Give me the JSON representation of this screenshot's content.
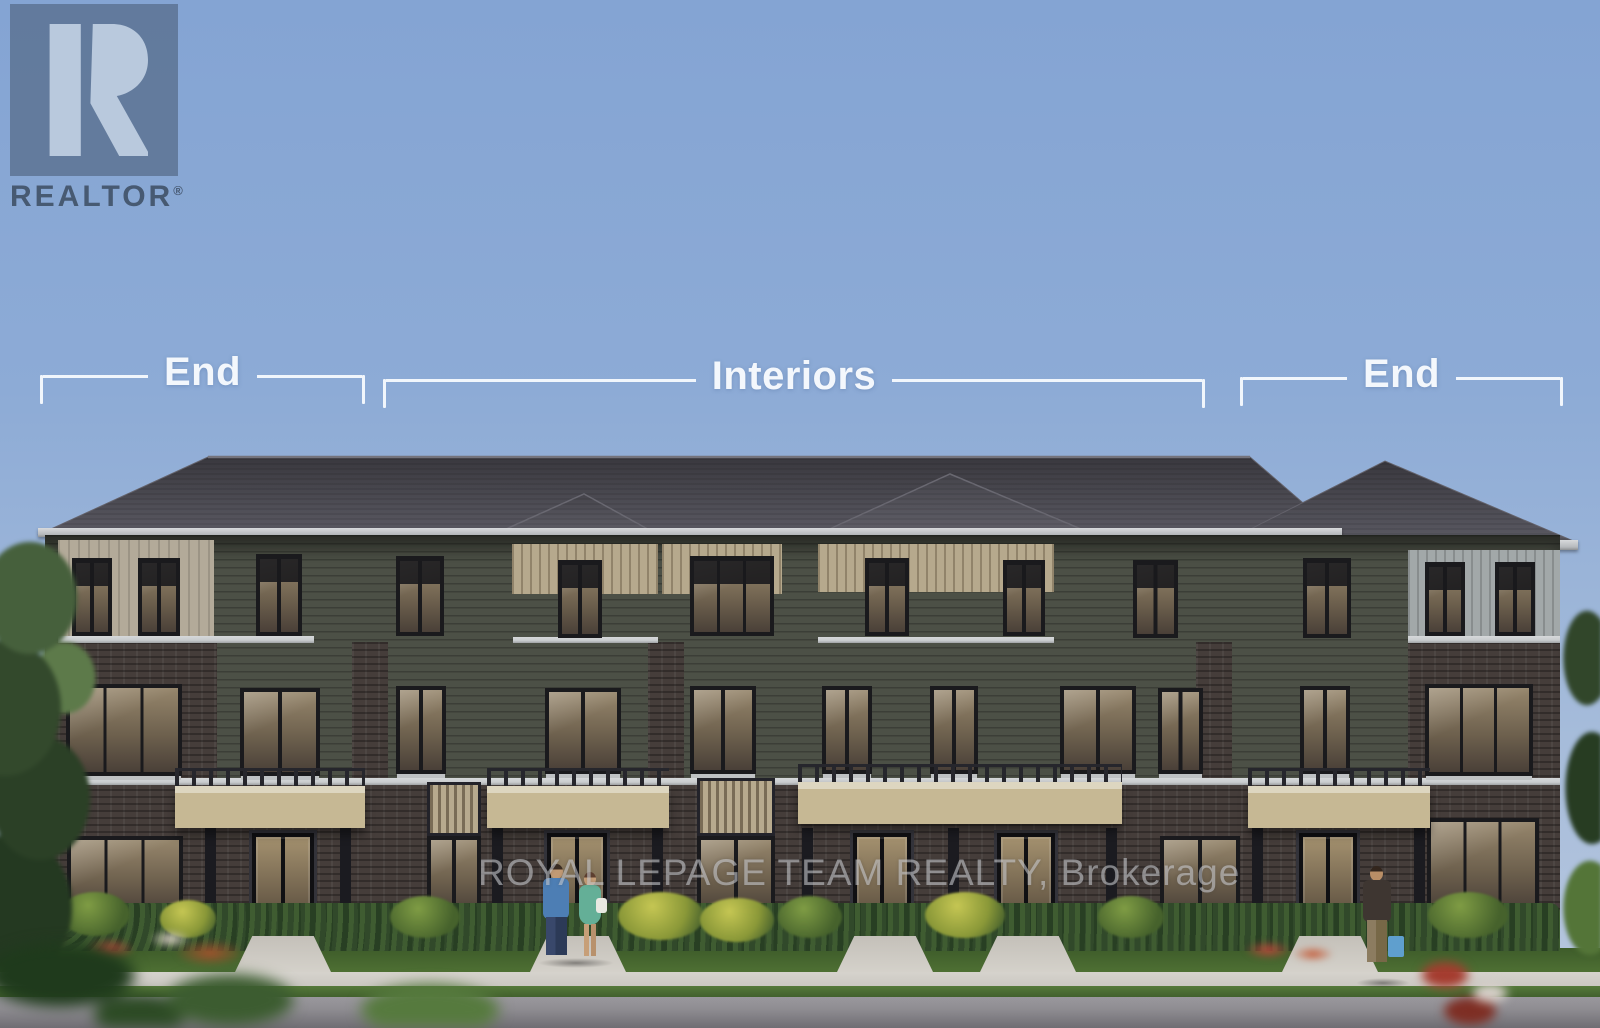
{
  "annotations": {
    "end_left": "End",
    "interiors": "Interiors",
    "end_right": "End"
  },
  "watermarks": {
    "realtor_logo": "REALTOR",
    "registered": "®",
    "brokerage": "ROYAL LEPAGE TEAM REALTY, Brokerage"
  },
  "palette": {
    "sky_top": "#84a4d3",
    "sky_horizon": "#b9c8e0",
    "roof_dark": "#39383e",
    "roof_light": "#5b5a63",
    "brick": "#453d3a",
    "siding_olive": "#4c5046",
    "siding_tan_stripe": "#b6a98d",
    "siding_light_tan": "#b3aa99",
    "siding_light_gray": "#a2a8a9",
    "trim_light": "#c9ccce",
    "awning_light": "#ddd6c0",
    "awning_tan": "#c6b894",
    "glass_light": "#96866c",
    "glass_dark": "#4a4038",
    "hedge_green": "#31492a",
    "bush_green": "#7f9c44",
    "bush_yellow": "#c5c653",
    "flower_red": "#b5493a",
    "lawn_green": "#4f7134",
    "sidewalk_gray": "#c9c6c0",
    "road_gray": "#8e8c91",
    "annotation_white": "#f3f7fc",
    "watermark_gray": "#d2d4d8",
    "logo_box_blue": "#566c8a",
    "logo_mark_light": "#b9c9dd",
    "logo_text_slate": "#3e4e64"
  }
}
